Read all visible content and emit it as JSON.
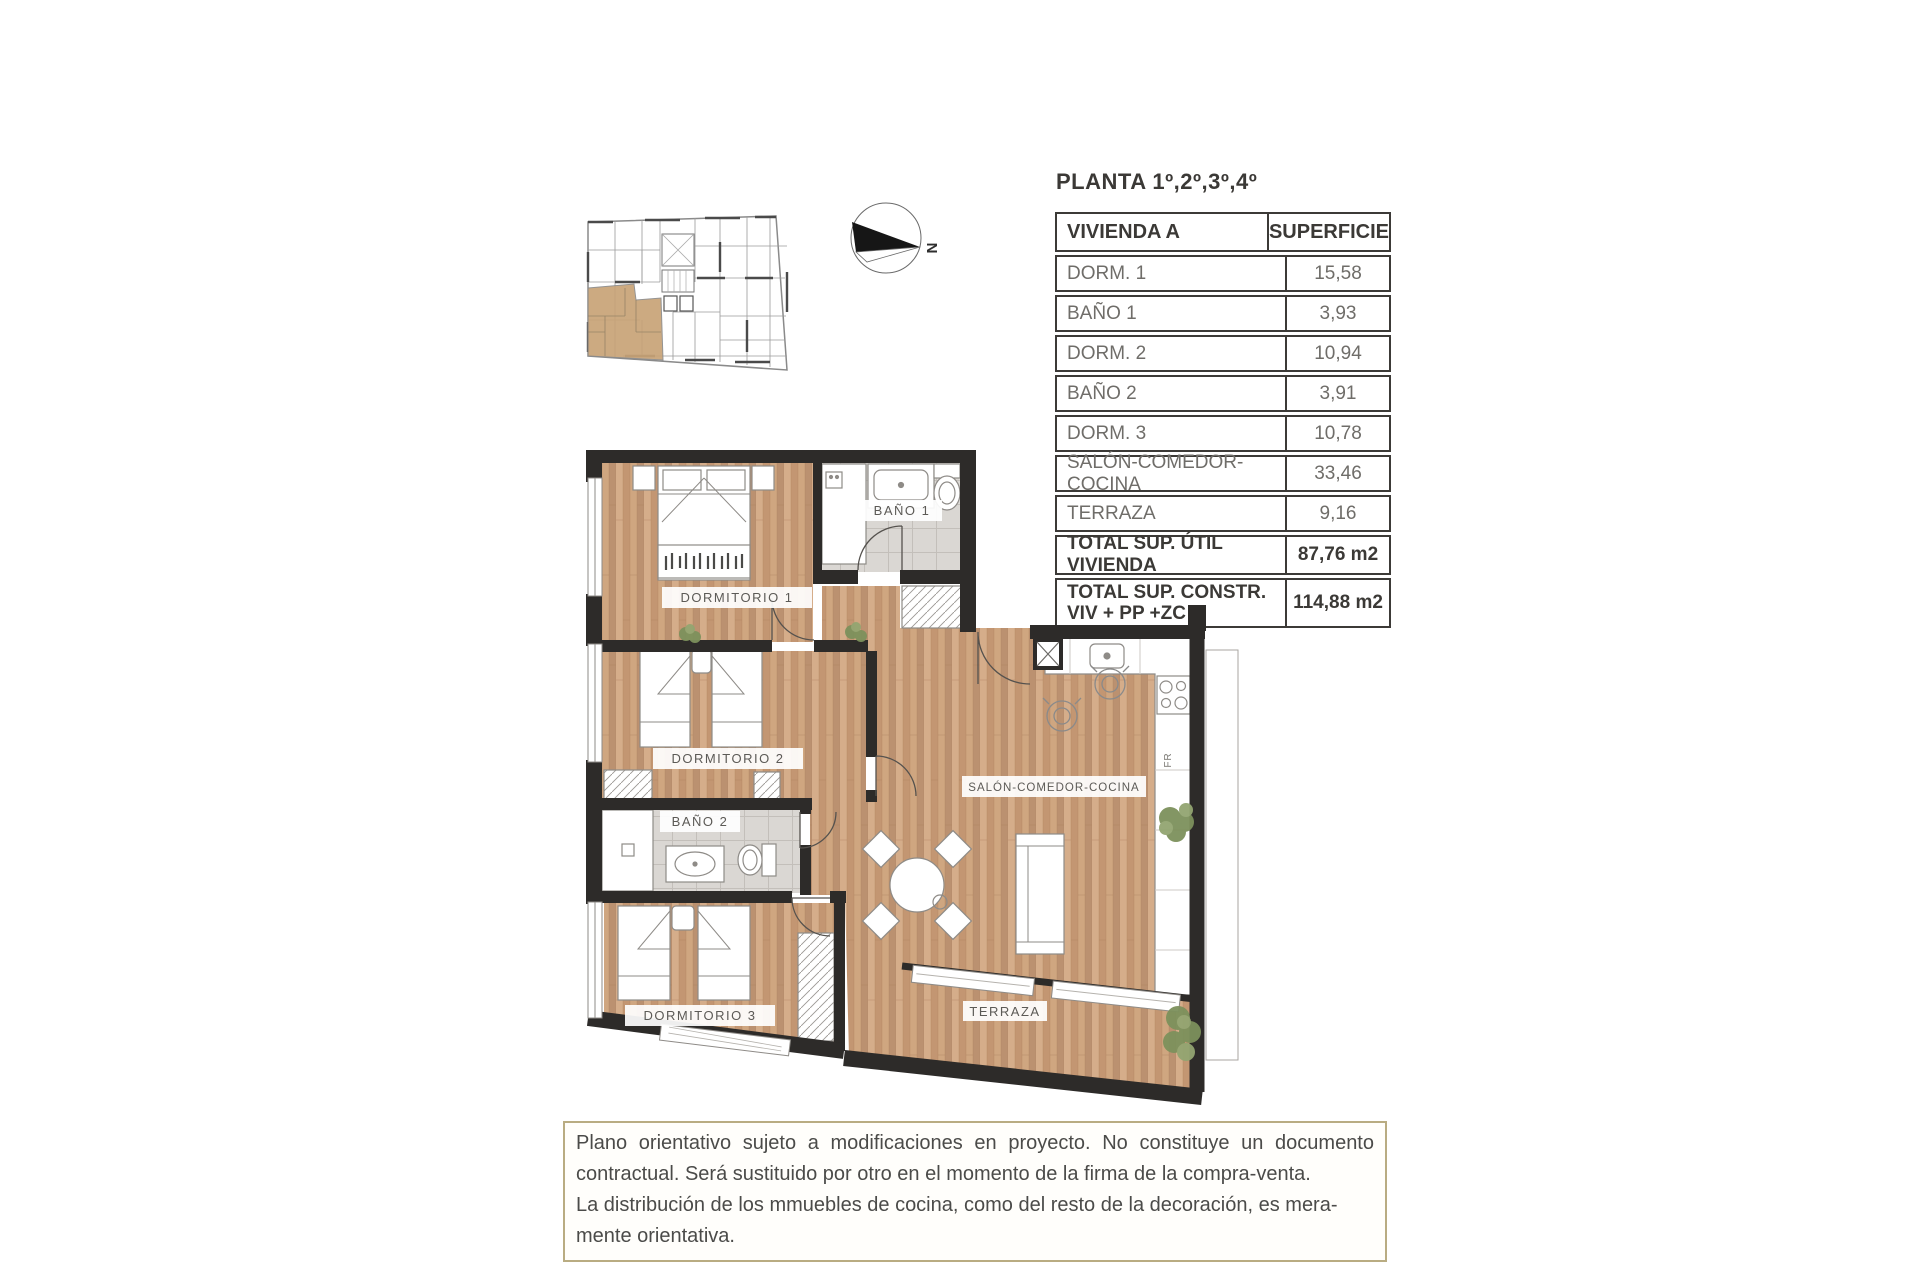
{
  "plan_header": {
    "title": "PLANTA 1º,2º,3º,4º"
  },
  "compass": {
    "north_label": "N"
  },
  "area_table": {
    "columns": [
      "VIVIENDA A",
      "SUPERFICIE"
    ],
    "rows": [
      {
        "label": "DORM. 1",
        "value": "15,58"
      },
      {
        "label": "BAÑO 1",
        "value": "3,93"
      },
      {
        "label": "DORM. 2",
        "value": "10,94"
      },
      {
        "label": "BAÑO 2",
        "value": "3,91"
      },
      {
        "label": "DORM. 3",
        "value": "10,78"
      },
      {
        "label": "SALÓN-COMEDOR-COCINA",
        "value": "33,46"
      },
      {
        "label": "TERRAZA",
        "value": "9,16"
      }
    ],
    "totals": [
      {
        "label_line1": "TOTAL SUP. ÚTIL VIVIENDA",
        "label_line2": "",
        "value": "87,76 m2"
      },
      {
        "label_line1": "TOTAL SUP. CONSTR.",
        "label_line2": "VIV + PP +ZC",
        "value": "114,88 m2"
      }
    ]
  },
  "floor_plan": {
    "room_labels": {
      "dormitorio1": "DORMITORIO 1",
      "bano1": "BAÑO 1",
      "dormitorio2": "DORMITORIO 2",
      "bano2": "BAÑO 2",
      "dormitorio3": "DORMITORIO 3",
      "salon": "SALÓN-COMEDOR-COCINA",
      "terraza": "TERRAZA",
      "fridge": "FR"
    }
  },
  "disclaimer": {
    "lines": [
      "Plano orientativo sujeto a modificaciones en proyecto. No constituye un documento",
      "contractual. Será sustituido por otro en el momento de la firma de la compra-venta.",
      "La distribución de los mmuebles de cocina, como del resto de la decoración, es mera-",
      "mente orientativa."
    ]
  }
}
